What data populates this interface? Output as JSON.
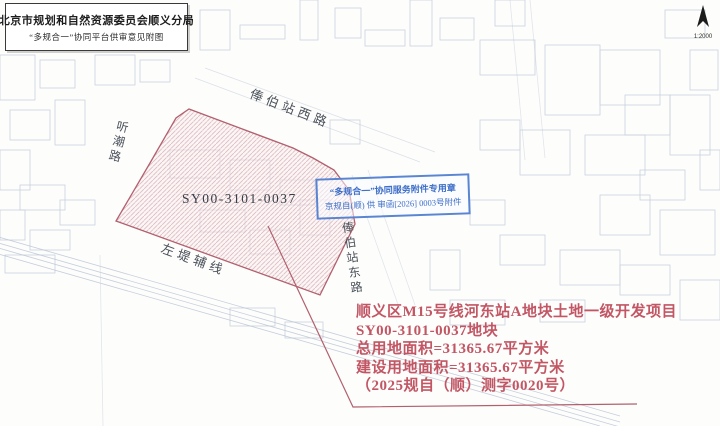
{
  "document": {
    "title": "北京市规划和自然资源委员会顺义分局",
    "subtitle": "“多规合一”协同平台供审意见附图"
  },
  "map": {
    "scale_label": "1:2000",
    "parcel_id": "SY00-3101-0037",
    "parcel_fill_color": "#e8c4ca",
    "parcel_outline_color": "#b2606e",
    "road_labels": {
      "fengbo_west": "俸伯站西路",
      "tingchao": "听潮路",
      "fengbo_east": "俸伯站东路",
      "zuodi_fuxian": "左堤辅线"
    }
  },
  "stamp": {
    "line1": "“多规合一”协同服务附件专用章",
    "line2": "京规自(顺) 供 审函[2026] 0003号附件",
    "color": "#3f6fc9"
  },
  "annotation": {
    "color": "#c25664",
    "lines": [
      "顺义区M15号线河东站A地块土地一级开发项目",
      "SY00-3101-0037地块",
      "总用地面积=31365.67平方米",
      "建设用地面积=31365.67平方米",
      "（2025规自（顺）测字0020号）"
    ]
  }
}
